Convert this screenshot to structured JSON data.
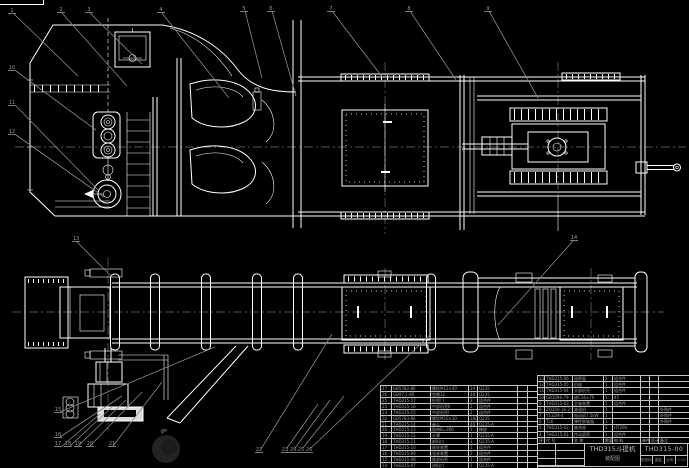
{
  "title_block": {
    "product": "THD315斗提机",
    "drawing_type": "装配图",
    "drawing_no": "THD315-00",
    "info_cells": [
      "阶段标记",
      "重量",
      "比例",
      "1:10"
    ]
  },
  "bom_right": {
    "headers": [
      "序号",
      "代  号",
      "名  称",
      "数量",
      "材  料",
      "单件",
      "总计",
      "备注"
    ],
    "rows": [
      [
        "13",
        "THD315-06",
        "观察窗",
        "2",
        "组合件",
        "",
        "",
        ""
      ],
      [
        "12",
        "THD315-05",
        "机座",
        "1",
        "组合件",
        "",
        "",
        ""
      ],
      [
        "11",
        "THD315-04",
        "头部机壳",
        "1",
        "组合件",
        "",
        "",
        ""
      ],
      [
        "10",
        "GB1096-79",
        "键C16×70",
        "1",
        "45",
        "",
        "",
        ""
      ],
      [
        "9",
        "THD315-03",
        "主轴装置",
        "1",
        "组合件",
        "",
        "",
        ""
      ],
      [
        "8",
        "ZQ350-16.3",
        "减速机",
        "1",
        "",
        "",
        "",
        "外购件"
      ],
      [
        "7",
        "Y132M-4",
        "电动机7.5kW",
        "1",
        "",
        "",
        "",
        "外购件"
      ],
      [
        "6",
        "TL6",
        "弹性联轴器",
        "1",
        "",
        "",
        "",
        "外购件"
      ],
      [
        "5",
        "THD315-02",
        "轴承座",
        "2",
        "HT200",
        "",
        "",
        ""
      ],
      [
        "4",
        "THD315-01",
        "传动滚筒",
        "1",
        "组合件",
        "",
        "",
        ""
      ]
    ]
  },
  "bom_left": {
    "rows": [
      [
        "27",
        "GB5782-86",
        "螺栓M12×40",
        "24",
        "Q235",
        "",
        ""
      ],
      [
        "26",
        "GB97.1-85",
        "垫圈12",
        "48",
        "Q235",
        "",
        ""
      ],
      [
        "25",
        "THD315-17",
        "检视门",
        "2",
        "组合件",
        "",
        ""
      ],
      [
        "24",
        "THD315-16",
        "中部机壳Ⅱ",
        "2",
        "组合件",
        "",
        ""
      ],
      [
        "23",
        "THD315-15",
        "中部机壳Ⅰ",
        "2",
        "组合件",
        "",
        ""
      ],
      [
        "22",
        "GB5783-86",
        "螺栓M10×30",
        "180",
        "Q235",
        "",
        ""
      ],
      [
        "21",
        "THD315-14",
        "畚斗",
        "46",
        "Q235-A",
        "",
        ""
      ],
      [
        "20",
        "THD315-13",
        "胶带B=300",
        "1",
        "橡胶",
        "",
        ""
      ],
      [
        "19",
        "THD315-12",
        "头罩",
        "1",
        "Q235-A",
        "",
        ""
      ],
      [
        "18",
        "THD315-11",
        "卸料口",
        "1",
        "Q235-A",
        "",
        ""
      ],
      [
        "17",
        "THD315-10",
        "尾轮装置",
        "1",
        "组合件",
        "",
        ""
      ],
      [
        "16",
        "THD315-09",
        "张紧装置",
        "2",
        "组合件",
        "",
        ""
      ],
      [
        "15",
        "THD315-08",
        "尾部机壳",
        "1",
        "组合件",
        "",
        ""
      ],
      [
        "14",
        "THD315-07",
        "进料口",
        "1",
        "Q235-A",
        "",
        ""
      ]
    ]
  },
  "balloons": [
    "1",
    "2",
    "3",
    "4",
    "5",
    "6",
    "7",
    "8",
    "9",
    "10",
    "11",
    "12",
    "13",
    "14",
    "15",
    "16",
    "17",
    "18",
    "19",
    "20",
    "21",
    "22",
    "23",
    "24",
    "25",
    "26"
  ]
}
